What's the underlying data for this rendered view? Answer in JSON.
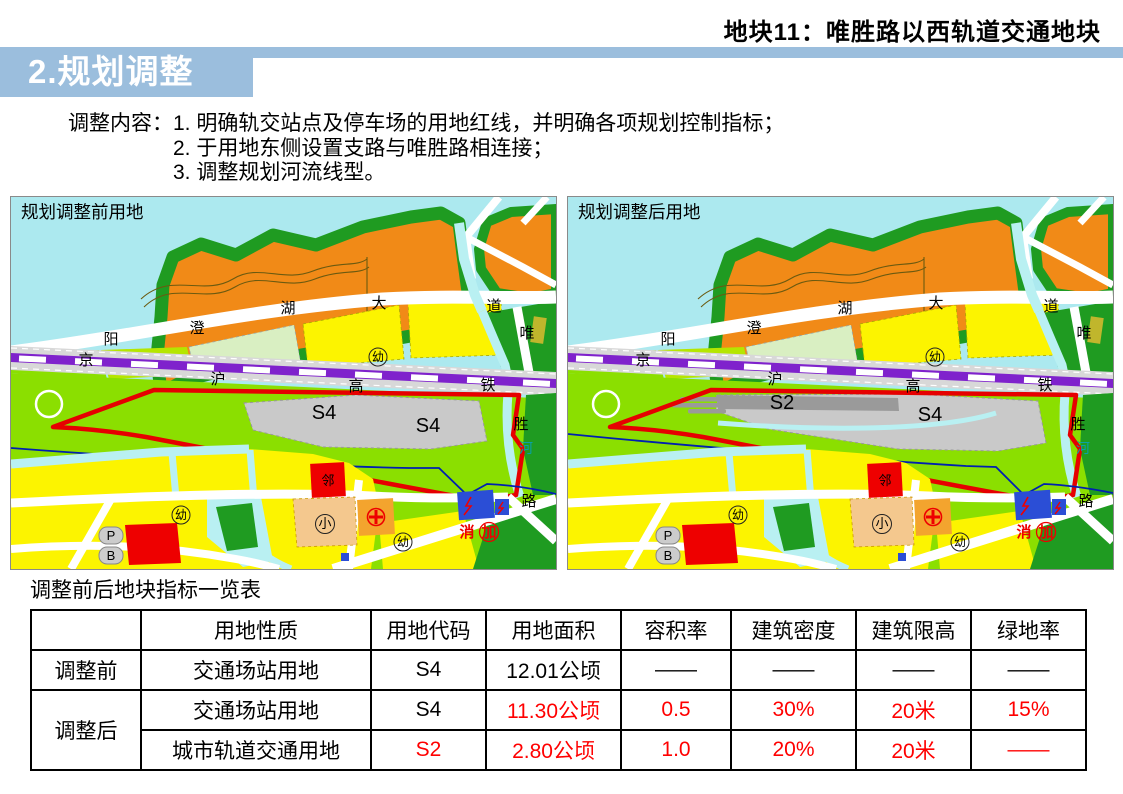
{
  "header": {
    "top_title": "地块11：唯胜路以西轨道交通地块",
    "section_title": "2.规划调整",
    "accent_color": "#9bbedd"
  },
  "note": {
    "label": "调整内容：",
    "items": [
      "1. 明确轨交站点及停车场的用地红线，并明确各项规划控制指标；",
      "2. 于用地东侧设置支路与唯胜路相连接；",
      "3. 调整规划河流线型。"
    ]
  },
  "maps": {
    "before": {
      "title": "规划调整前用地",
      "zones": [
        "S4",
        "S4"
      ]
    },
    "after": {
      "title": "规划调整后用地",
      "zones": [
        "S2",
        "S4"
      ]
    },
    "labels": {
      "avenue": [
        "阳",
        "澄",
        "湖",
        "大",
        "道"
      ],
      "railway": [
        "京",
        "沪",
        "高",
        "铁"
      ],
      "road_east": [
        "唯",
        "胜",
        "路"
      ],
      "river": "河",
      "kindergarten": "幼",
      "neighborhood": "邻",
      "school": "小",
      "parking": "P",
      "bus": "B",
      "fire": "消",
      "gas": "加"
    },
    "palette": {
      "water": "#ace9ef",
      "green": "#1f9b21",
      "orange": "#f18a17",
      "chartreuse": "#8bdf00",
      "yellow": "#fcf400",
      "pale_green": "#d9efc2",
      "yellow_green": "#b5e600",
      "road_white": "#ffffff",
      "rail_gray": "#d8d8d8",
      "rail_purple": "#7f22cc",
      "zone_gray": "#c9c9c9",
      "zone_dark_gray": "#9a9a9a",
      "red_line": "#e60000",
      "river_blue": "#0020b0",
      "canal": "#b9f0f2",
      "school_peach": "#f4c88e",
      "hospital_orange": "#f3a42e",
      "utility_blue": "#2b4ed6",
      "olive": "#c0b62c",
      "parcel_red": "#ee0000",
      "label_teal": "#0aa0a8"
    }
  },
  "table": {
    "title": "调整前后地块指标一览表",
    "columns": [
      "",
      "用地性质",
      "用地代码",
      "用地面积",
      "容积率",
      "建筑密度",
      "建筑限高",
      "绿地率"
    ],
    "rows": [
      {
        "group": "调整前",
        "cells": [
          "交通场站用地",
          "S4",
          "12.01公顷",
          "——",
          "——",
          "——",
          "——"
        ]
      },
      {
        "group": "调整后",
        "cells": [
          "交通场站用地",
          "S4",
          "11.30公顷",
          "0.5",
          "30%",
          "20米",
          "15%"
        ]
      },
      {
        "group": "",
        "cells": [
          "城市轨道交通用地",
          "S2",
          "2.80公顷",
          "1.0",
          "20%",
          "20米",
          "——"
        ]
      }
    ],
    "red_color": "#ff0000"
  }
}
